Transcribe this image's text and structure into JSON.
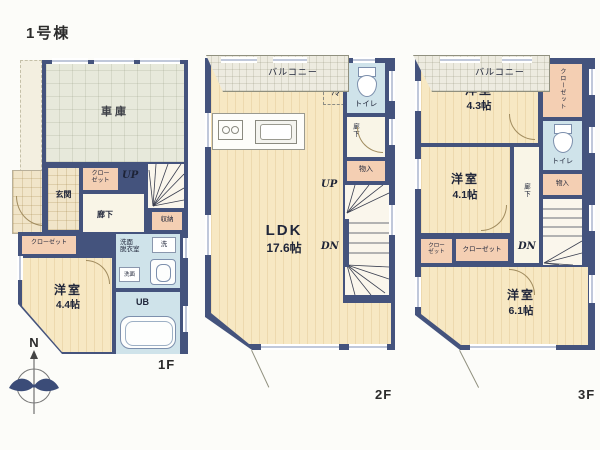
{
  "title": "1号棟",
  "compass_label": "N",
  "floor1": {
    "floor_label": "1F",
    "garage": "車庫",
    "entrance": "玄関",
    "entrance_closet": "クロー\nゼット",
    "up": "UP",
    "hallway": "廊下",
    "storage": "収納",
    "washroom": "洗面\n脱衣室",
    "washer": "洗",
    "vanity": "洗面",
    "closet": "クローゼット",
    "bedroom_name": "洋室",
    "bedroom_size": "4.4帖",
    "bath": "UB"
  },
  "floor2": {
    "floor_label": "2F",
    "fridge": "冷",
    "toilet": "トイレ",
    "hallway": "廊下",
    "storage": "物入",
    "up": "UP",
    "down": "DN",
    "ldk_name": "LDK",
    "ldk_size": "17.6帖",
    "balcony": "バルコニー"
  },
  "floor3": {
    "floor_label": "3F",
    "bedroom1_name": "洋室",
    "bedroom1_size": "4.3帖",
    "closet1": "クローゼット",
    "toilet": "トイレ",
    "storage": "物入",
    "bedroom2_name": "洋室",
    "bedroom2_size": "4.1帖",
    "hallway": "廊下",
    "down": "DN",
    "closet2": "クロー\nゼット",
    "closet3": "クローゼット",
    "bedroom3_name": "洋室",
    "bedroom3_size": "6.1帖",
    "balcony": "バルコニー"
  },
  "colors": {
    "wall": "#44537d",
    "wood_floor": "#f7e8c3",
    "wet_room": "#cfe3ea",
    "closet": "#f4cfb3",
    "garage": "#e7e9db",
    "balcony": "#edebe0"
  },
  "icons": [
    "compass-icon",
    "toilet-icon",
    "bathtub-icon",
    "kitchen-sink-icon",
    "stove-icon",
    "washer-icon",
    "vanity-sink-icon"
  ]
}
